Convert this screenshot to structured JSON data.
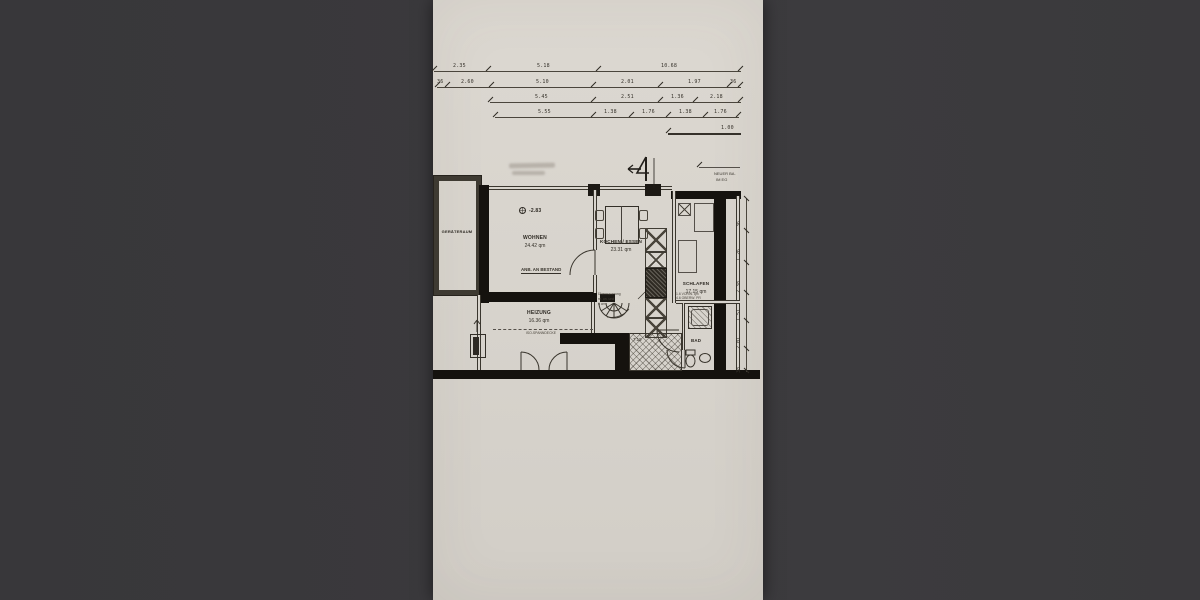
{
  "colors": {
    "photo_background": "#3a393c",
    "paper": "#d8d4cd",
    "ink": "#2b2822",
    "wall_fill": "#15120e"
  },
  "dims": {
    "row1": [
      "2.35",
      "5.18",
      "10.68"
    ],
    "row2": [
      "36",
      "2.60",
      "5.10",
      "2.01",
      "1.97",
      "36"
    ],
    "row3": [
      "5.45",
      "2.51",
      "1.36",
      "2.18"
    ],
    "row4": [
      "5.55",
      "1.38",
      "1.76",
      "1.38",
      "1.76"
    ],
    "vert": [
      "36",
      "1.26",
      "2.38",
      "1.51",
      "2.01",
      "38"
    ],
    "scale_label": "1.00"
  },
  "rooms": {
    "geraeteraum": {
      "name": "GERÄTERAUM"
    },
    "wohnen": {
      "name": "WOHNEN",
      "area": "24.42 qm"
    },
    "kochen": {
      "name": "KOCHEN / ESSEN",
      "area": "23.31 qm"
    },
    "schlafen": {
      "name": "SCHLAFEN",
      "area": "17.15 qm"
    },
    "heizung": {
      "name": "HEIZUNG",
      "area": "16.36 qm"
    },
    "flur": {
      "area": "7.19"
    },
    "bad": {
      "name": "BAD"
    }
  },
  "annotations": {
    "level": "-2.83",
    "anbindung": "ANB. AN BESTAND",
    "ueberm_1": "Übermauerung",
    "ueberm_2": "re. un. und",
    "ueberm_3": "6 cm",
    "decke": "ISO-SPANNDECKE",
    "balkon_1": "NEUER BA.",
    "balkon_2": "IM EG",
    "bad_note_1": "1.6 VORW. qm",
    "bad_note_2": "4.6 OBERW. PR"
  }
}
